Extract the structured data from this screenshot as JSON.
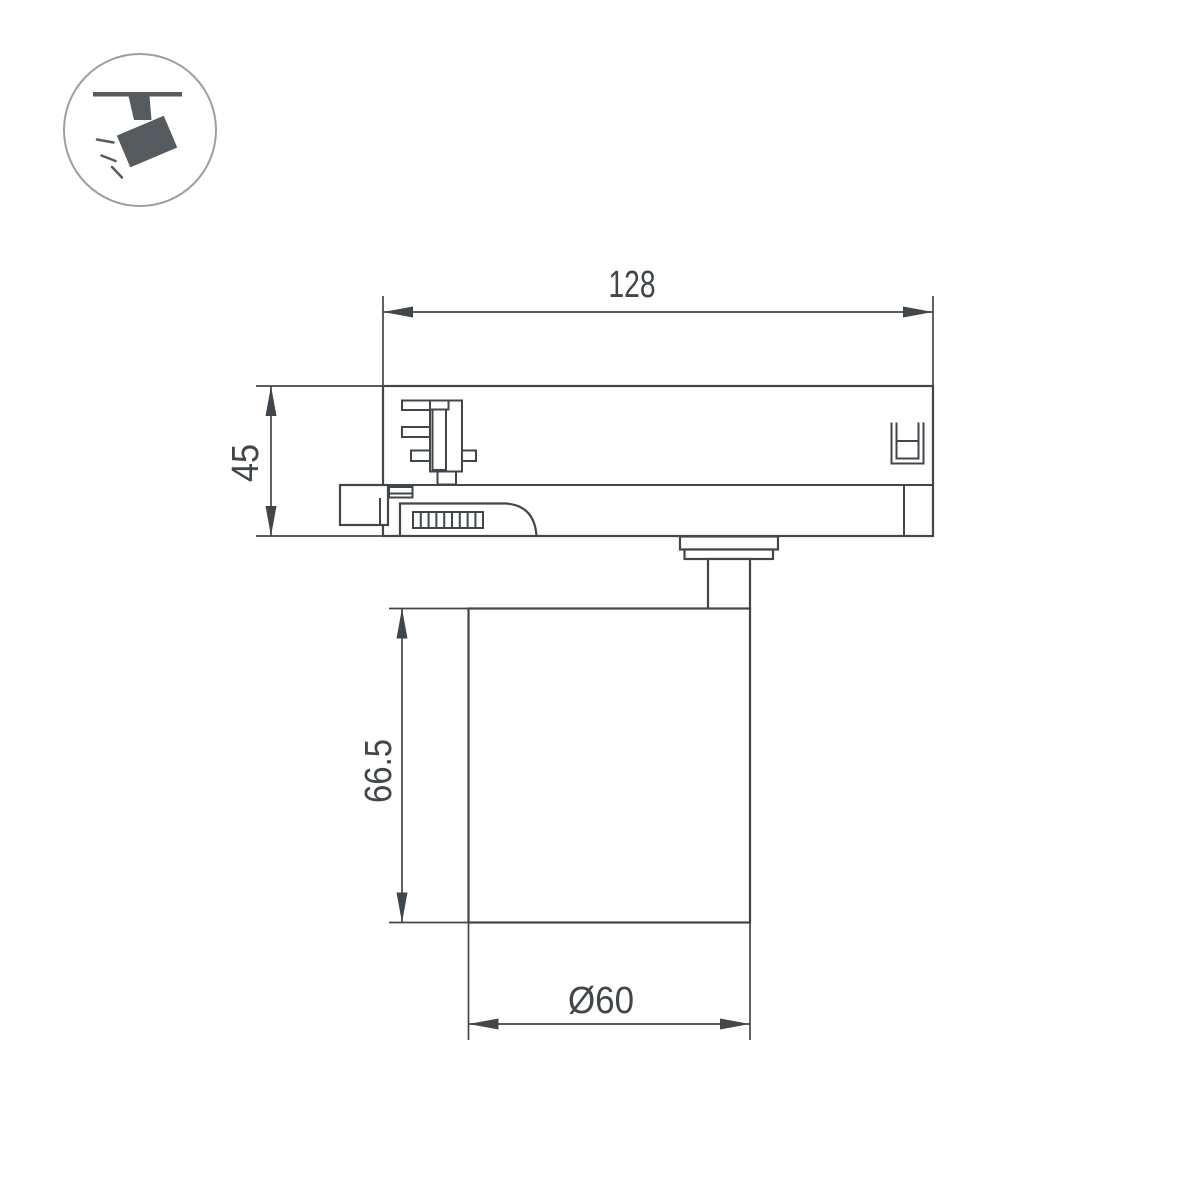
{
  "page": {
    "background": "#ffffff"
  },
  "icon": {
    "name": "track-spotlight-icon",
    "color": "#565b60",
    "circle_stroke": "#9ba0a4"
  },
  "drawing": {
    "type": "dimensioned-technical-drawing",
    "line_color": "#41464b",
    "dimensions": {
      "adapter_width": {
        "label": "128"
      },
      "adapter_height": {
        "label": "45"
      },
      "body_height": {
        "label": "66.5"
      },
      "body_diameter": {
        "label": "Ø60"
      }
    }
  }
}
